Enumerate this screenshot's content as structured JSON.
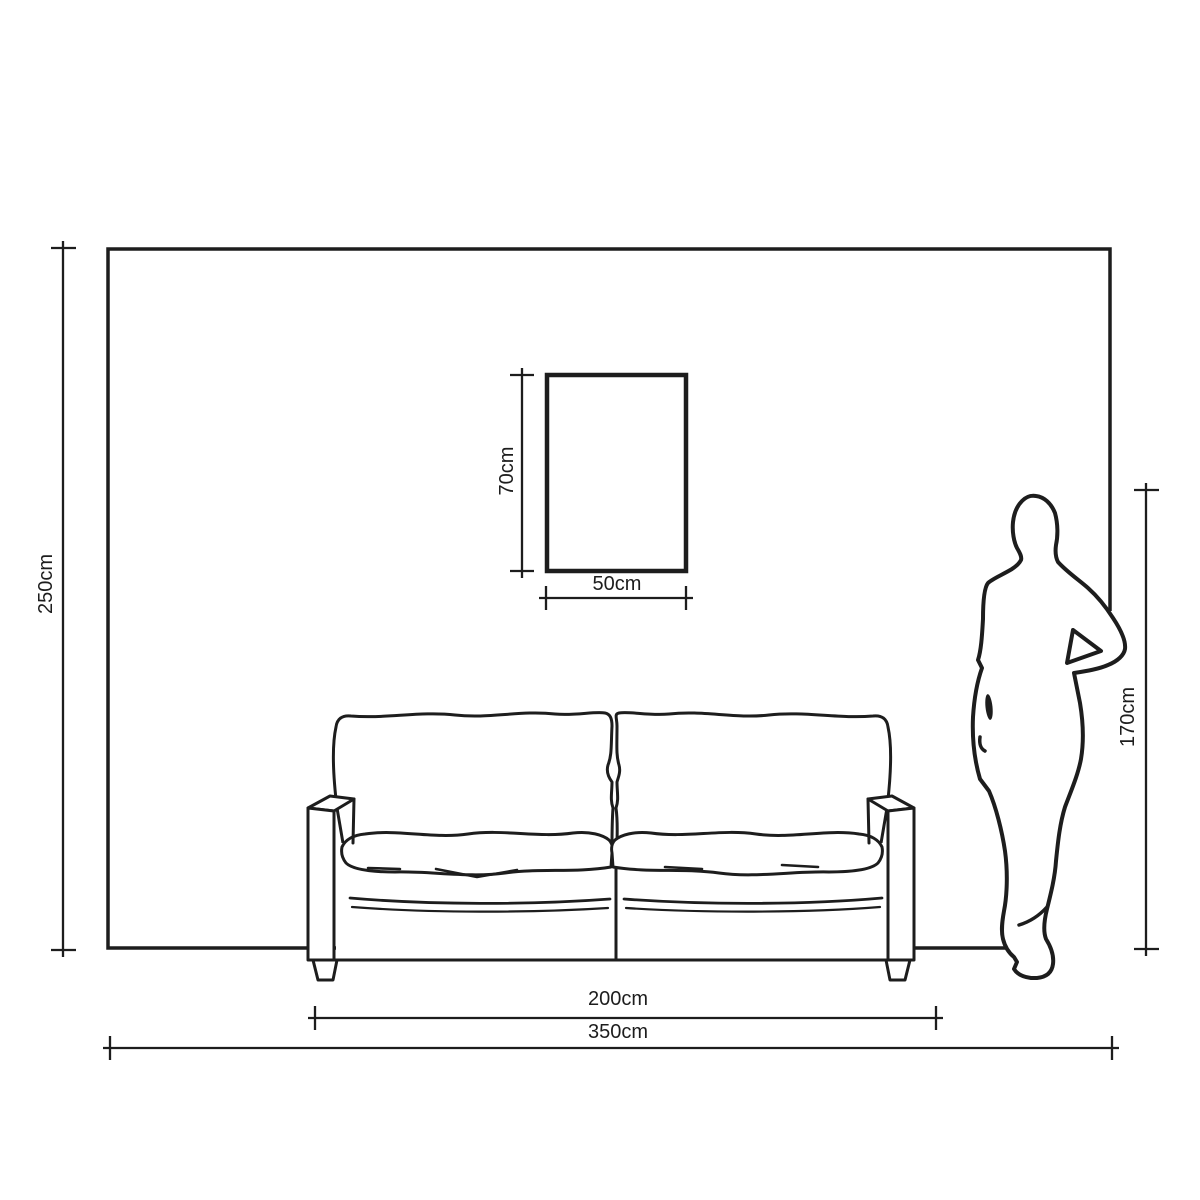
{
  "diagram": {
    "background_color": "#ffffff",
    "line_color": "#1d1d1d",
    "unit": "cm",
    "labels": {
      "wall_height": "250cm",
      "wall_width": "350cm",
      "artwork_height": "70cm",
      "artwork_width": "50cm",
      "sofa_width": "200cm",
      "person_height": "170cm"
    },
    "measurements": {
      "wall_height_cm": 250,
      "wall_width_cm": 350,
      "artwork_height_cm": 70,
      "artwork_width_cm": 50,
      "sofa_width_cm": 200,
      "person_height_cm": 170
    },
    "elements": [
      "wall",
      "artwork-frame",
      "two-seat-sofa",
      "person-silhouette"
    ]
  }
}
